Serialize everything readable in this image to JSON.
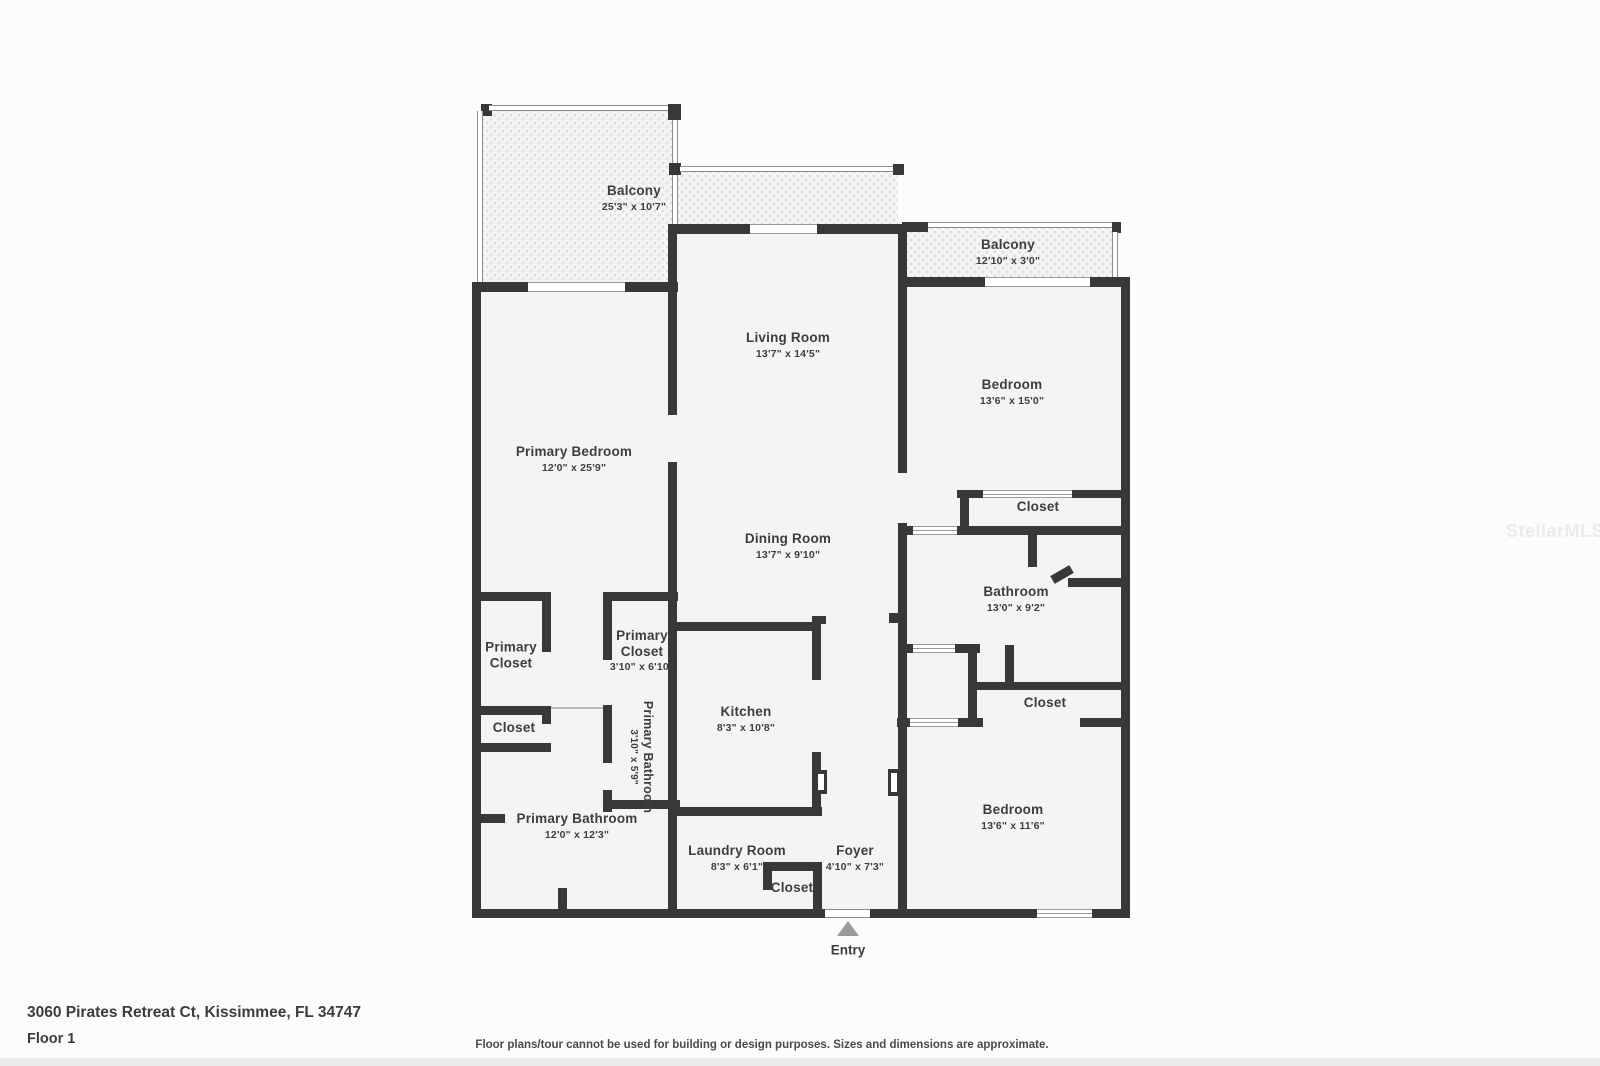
{
  "meta": {
    "address": "3060 Pirates Retreat Ct, Kissimmee, FL 34747",
    "floor_label": "Floor 1",
    "disclaimer": "Floor plans/tour cannot be used for building or design purposes. Sizes and dimensions are approximate.",
    "watermark": "StellarMLS"
  },
  "entry": {
    "label": "Entry"
  },
  "colors": {
    "wall": "#383838",
    "floor_fill": "#f4f4f4",
    "balcony_tile": "#e1e1e1",
    "label_text": "#3e3e3e",
    "entry_arrow": "#9b9b9b"
  },
  "rooms": {
    "balcony_main": {
      "name": "Balcony",
      "dims": "25'3\" x 10'7\""
    },
    "balcony_small": {
      "name": "Balcony",
      "dims": "12'10\" x 3'0\""
    },
    "living_room": {
      "name": "Living Room",
      "dims": "13'7\" x 14'5\""
    },
    "bedroom_top": {
      "name": "Bedroom",
      "dims": "13'6\" x 15'0\""
    },
    "primary_bedroom": {
      "name": "Primary Bedroom",
      "dims": "12'0\" x 25'9\""
    },
    "closet_bedroom_top": {
      "name": "Closet"
    },
    "dining_room": {
      "name": "Dining Room",
      "dims": "13'7\" x 9'10\""
    },
    "bathroom": {
      "name": "Bathroom",
      "dims": "13'0\" x 9'2\""
    },
    "primary_closet_large": {
      "name": "Primary Closet"
    },
    "primary_closet_small": {
      "name": "Primary Closet",
      "dims": "3'10\" x 6'10\""
    },
    "closet_hall": {
      "name": "Closet"
    },
    "kitchen": {
      "name": "Kitchen",
      "dims": "8'3\" x 10'8\""
    },
    "closet_primary": {
      "name": "Closet"
    },
    "primary_bathroom_small": {
      "name": "Primary Bathroom",
      "dims": "3'10\" x 5'9\""
    },
    "bedroom_bottom": {
      "name": "Bedroom",
      "dims": "13'6\" x 11'6\""
    },
    "primary_bathroom": {
      "name": "Primary Bathroom",
      "dims": "12'0\" x 12'3\""
    },
    "laundry_room": {
      "name": "Laundry Room",
      "dims": "8'3\" x 6'1\""
    },
    "foyer": {
      "name": "Foyer",
      "dims": "4'10\" x 7'3\""
    },
    "closet_laundry": {
      "name": "Closet"
    }
  }
}
